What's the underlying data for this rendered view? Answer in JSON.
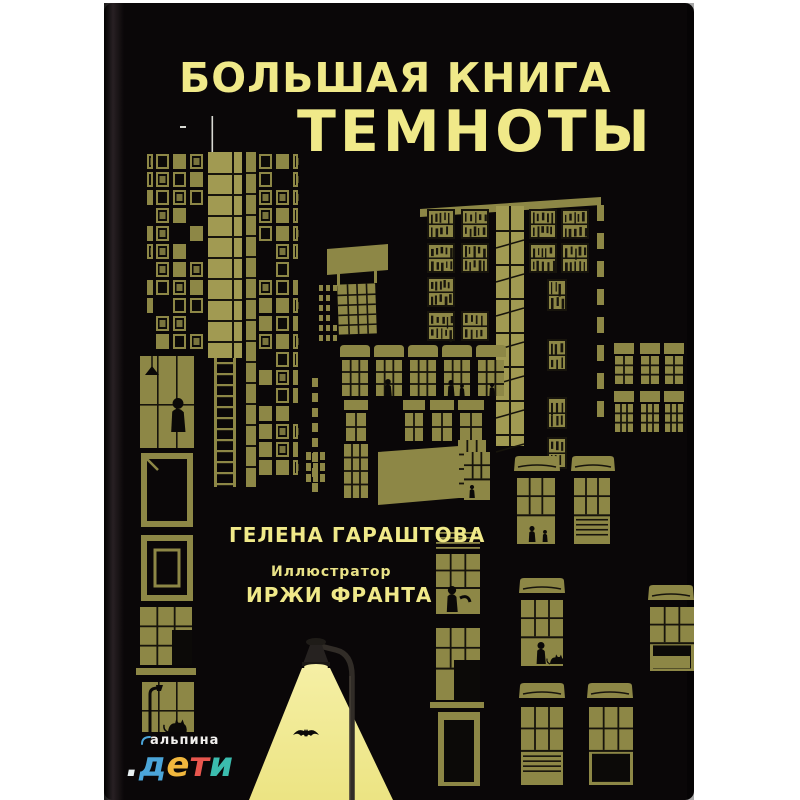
{
  "cover": {
    "title_line1": "БОЛЬШАЯ КНИГА",
    "title_line2": "ТЕМНОТЫ",
    "author": "ГЕЛЕНА ГАРАШТОВА",
    "illustrator_label": "Иллюстратор",
    "illustrator_name": "ИРЖИ ФРАНТА"
  },
  "publisher_logo": {
    "brand": "альпина",
    "sub_brand": ".дети",
    "letters": [
      {
        "char": ".",
        "color": "#e8f0f2"
      },
      {
        "char": "д",
        "color": "#4ba5d9"
      },
      {
        "char": "е",
        "color": "#f1b73d"
      },
      {
        "char": "т",
        "color": "#e8564e"
      },
      {
        "char": "и",
        "color": "#3bbcae"
      }
    ],
    "swoosh_color": "#4ba5d9"
  },
  "colors": {
    "page_bg": "#ffffff",
    "cover_bg": "#0a0708",
    "building_olive": "#8d8746",
    "bright_olive": "#a19a52",
    "dark_line": "#17140c",
    "window_dark": "#0c0a08",
    "title_yellow": "#f0e989",
    "light_cone_top": "#f5efa4",
    "light_cone_bottom": "#ece483",
    "silhouette": "#0b0908",
    "antenna_gray": "#d8d8d2",
    "pole_dark": "#312c27",
    "pole_highlight": "#4a443b"
  }
}
